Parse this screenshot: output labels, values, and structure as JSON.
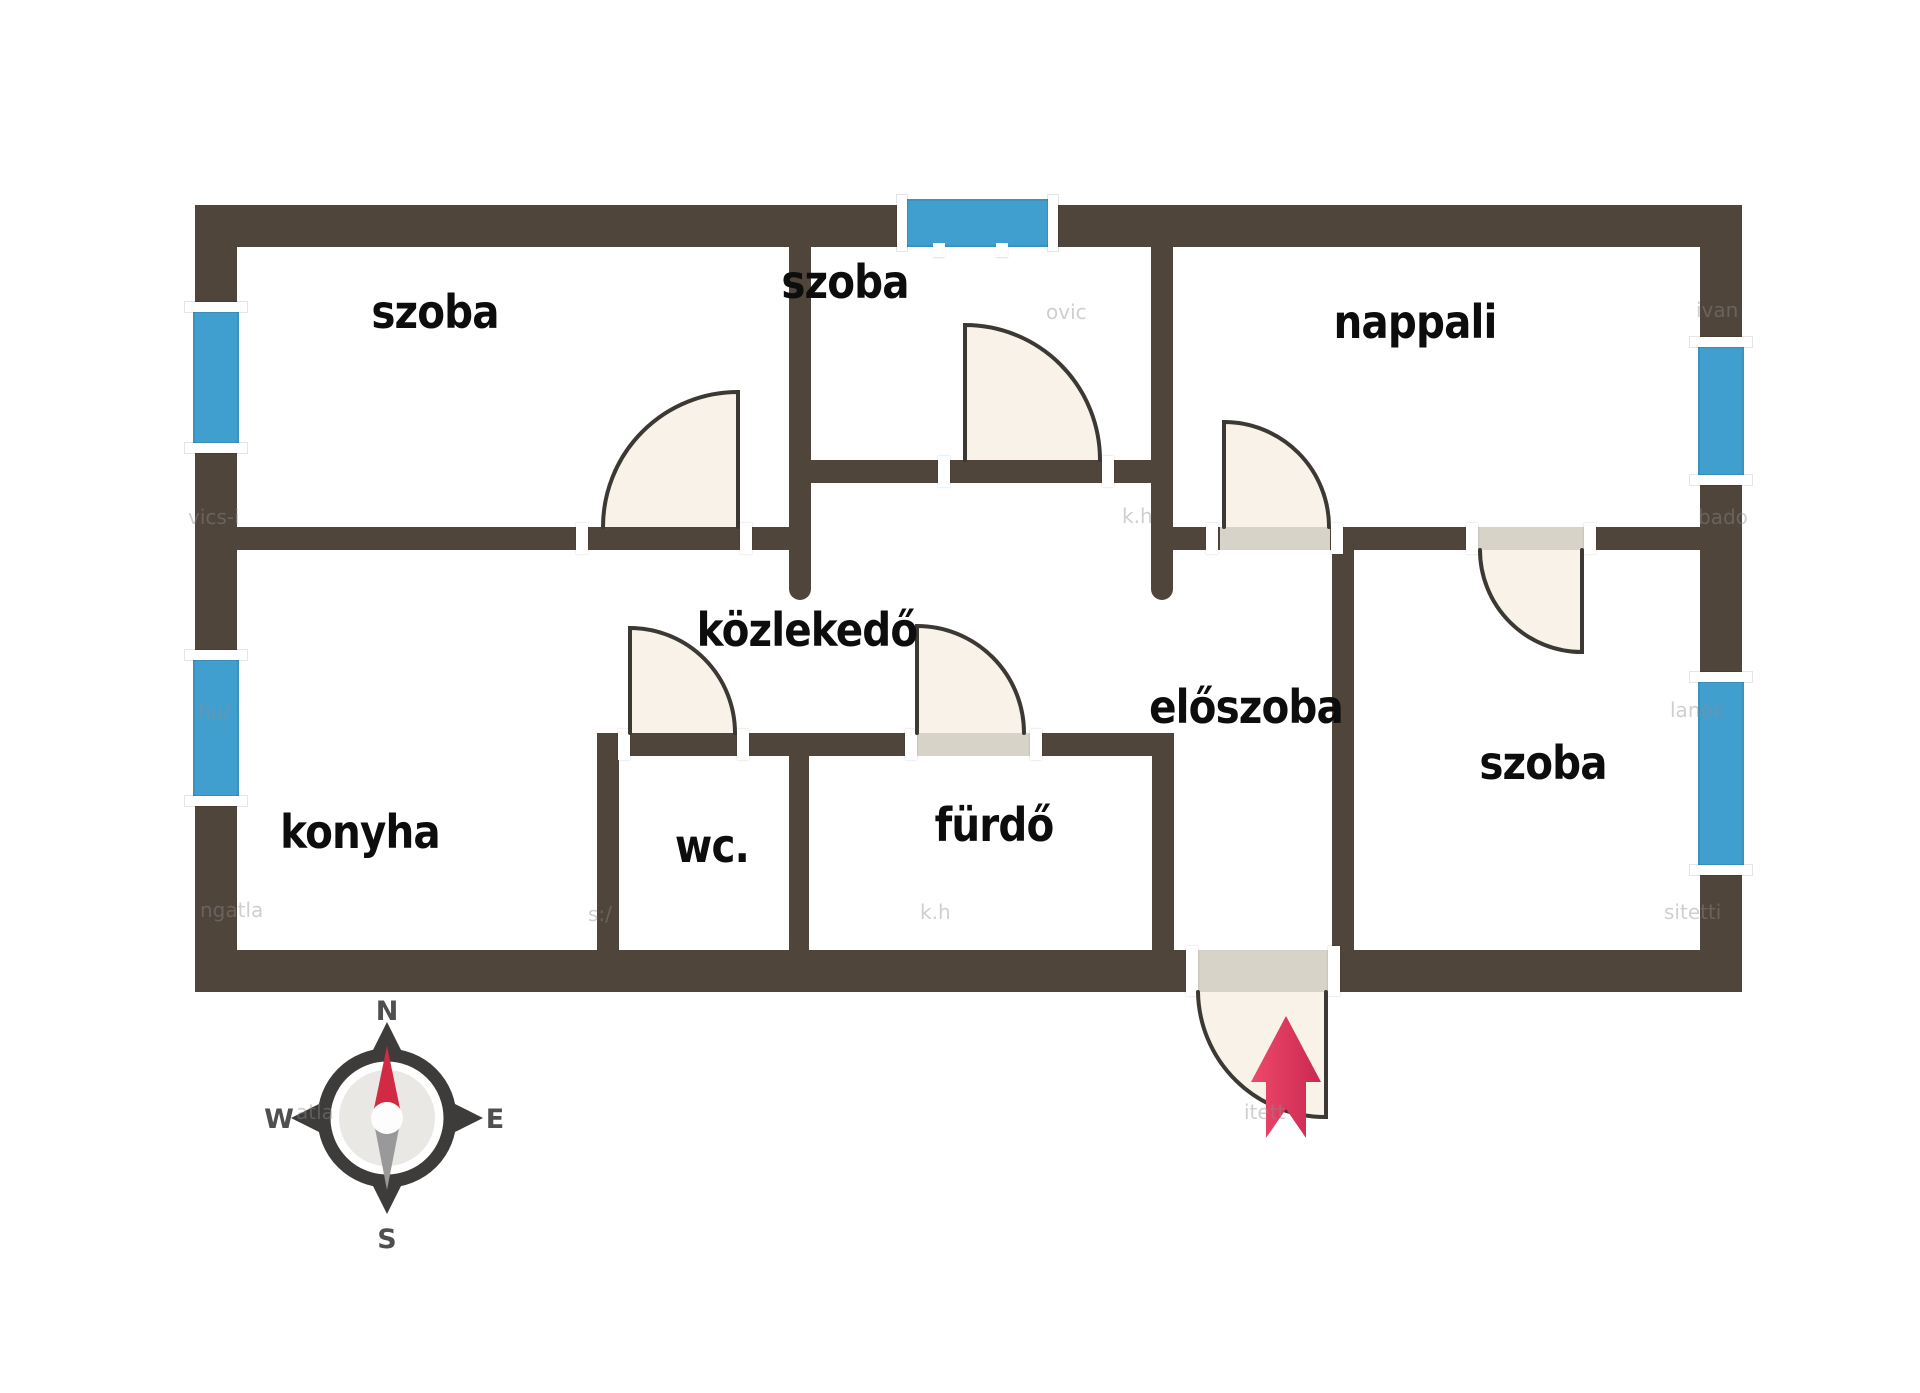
{
  "rooms": {
    "szoba_nw": {
      "label": "szoba"
    },
    "szoba_n": {
      "label": "szoba"
    },
    "nappali": {
      "label": "nappali"
    },
    "kozlekedo": {
      "label": "közlekedő"
    },
    "eloszoba": {
      "label": "előszoba"
    },
    "konyha": {
      "label": "konyha"
    },
    "wc": {
      "label": "wc."
    },
    "furdo": {
      "label": "fürdő"
    },
    "szoba_se": {
      "label": "szoba"
    }
  },
  "compass": {
    "n": "N",
    "e": "E",
    "s": "S",
    "w": "W"
  },
  "colors": {
    "wall": "#50453b",
    "window": "#419fd0",
    "door_fill": "#f8f2e9",
    "door_line": "#3c3833",
    "door_panel": "#d8d3c9",
    "entry_arrow_light": "#ef486c",
    "entry_arrow_dark": "#c92950",
    "background": "#ffffff"
  },
  "watermarks": [
    {
      "text": "vics-i",
      "x": 188,
      "y": 505
    },
    {
      "text": "hu/",
      "x": 198,
      "y": 700
    },
    {
      "text": "ngatla",
      "x": 200,
      "y": 898
    },
    {
      "text": "atla",
      "x": 296,
      "y": 1100
    },
    {
      "text": "ovic",
      "x": 1046,
      "y": 300
    },
    {
      "text": "k.h",
      "x": 1122,
      "y": 504
    },
    {
      "text": "s:/",
      "x": 588,
      "y": 902
    },
    {
      "text": "k.h",
      "x": 920,
      "y": 900
    },
    {
      "text": "ivan",
      "x": 1696,
      "y": 298
    },
    {
      "text": "bado",
      "x": 1698,
      "y": 505
    },
    {
      "text": "lanok",
      "x": 1670,
      "y": 698
    },
    {
      "text": "sitetti",
      "x": 1664,
      "y": 900
    },
    {
      "text": "itett",
      "x": 1244,
      "y": 1100
    }
  ]
}
